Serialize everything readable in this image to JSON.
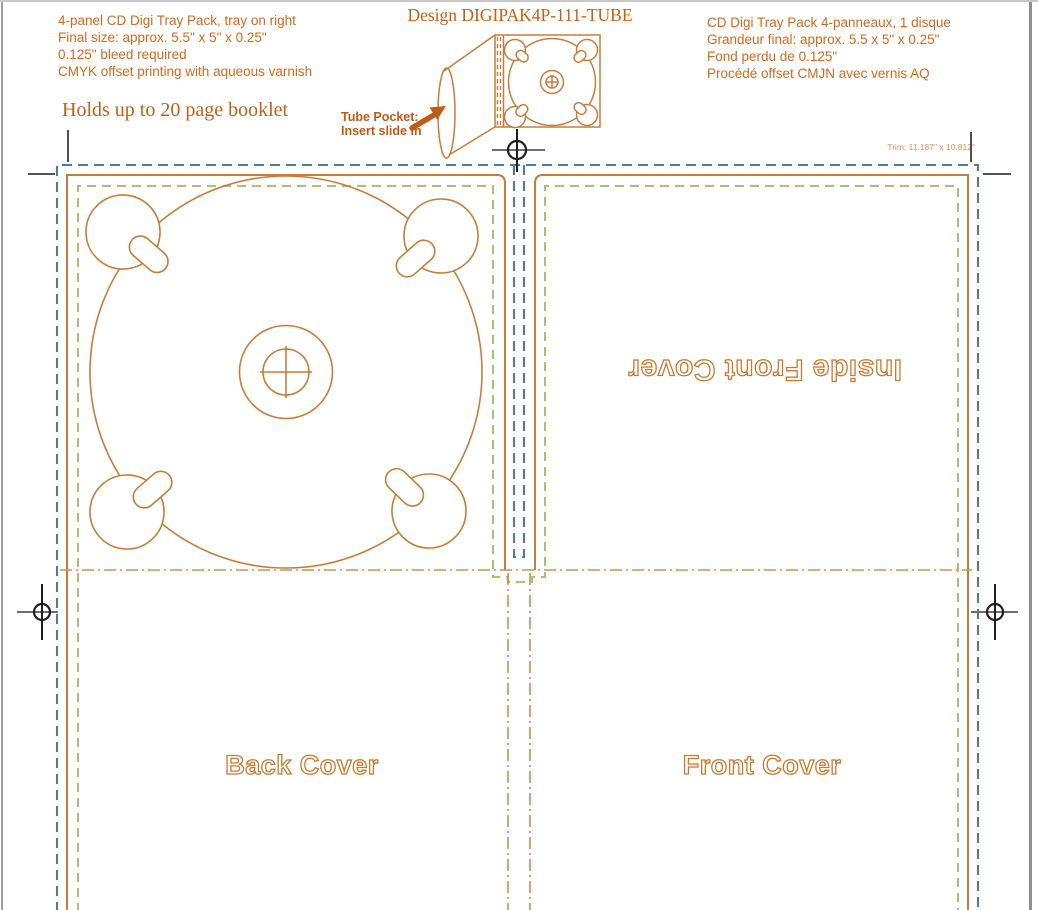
{
  "colors": {
    "text_orange": "#D2691E",
    "serif_orange": "#C2601A",
    "line_orange": "#C67D3C",
    "bleed_blue": "#4C79A9",
    "safe_green": "#A9C172",
    "fold_orange": "#D08D52",
    "arrow_orange": "#C05A17",
    "outline_label": "#C8792E",
    "trim_note_orange": "#D29457",
    "reg_dark": "#1E1E1E",
    "reg_gray": "#6E6E6E",
    "crop_dark": "#3C3C3C",
    "border_gray": "#9E9E9E"
  },
  "header": {
    "spec_en": {
      "lines": [
        "4-panel CD Digi Tray Pack, tray on right",
        "Final size: approx. 5.5\" x 5\" x 0.25\"",
        "0.125\" bleed required",
        "CMYK offset printing with aqueous varnish"
      ]
    },
    "tagline": "Holds up to 20 page booklet",
    "design_title": "Design DIGIPAK4P-111-TUBE",
    "spec_fr": {
      "lines": [
        "CD Digi Tray Pack 4-panneaux, 1 disque",
        "Grandeur final: approx. 5.5 x 5\" x 0.25\"",
        "Fond perdu de 0.125\"",
        "Procédé offset CMJN avec vernis AQ"
      ]
    }
  },
  "illustration": {
    "tube_pocket_label": "Tube Pocket:",
    "tube_pocket_instruction": "Insert slide in"
  },
  "dieline": {
    "trim_note": "Trim: 11.187\" x 10.812\"",
    "panel_labels": {
      "inside_front_cover": "Inside Front Cover",
      "back_cover": "Back Cover",
      "front_cover": "Front Cover"
    }
  }
}
